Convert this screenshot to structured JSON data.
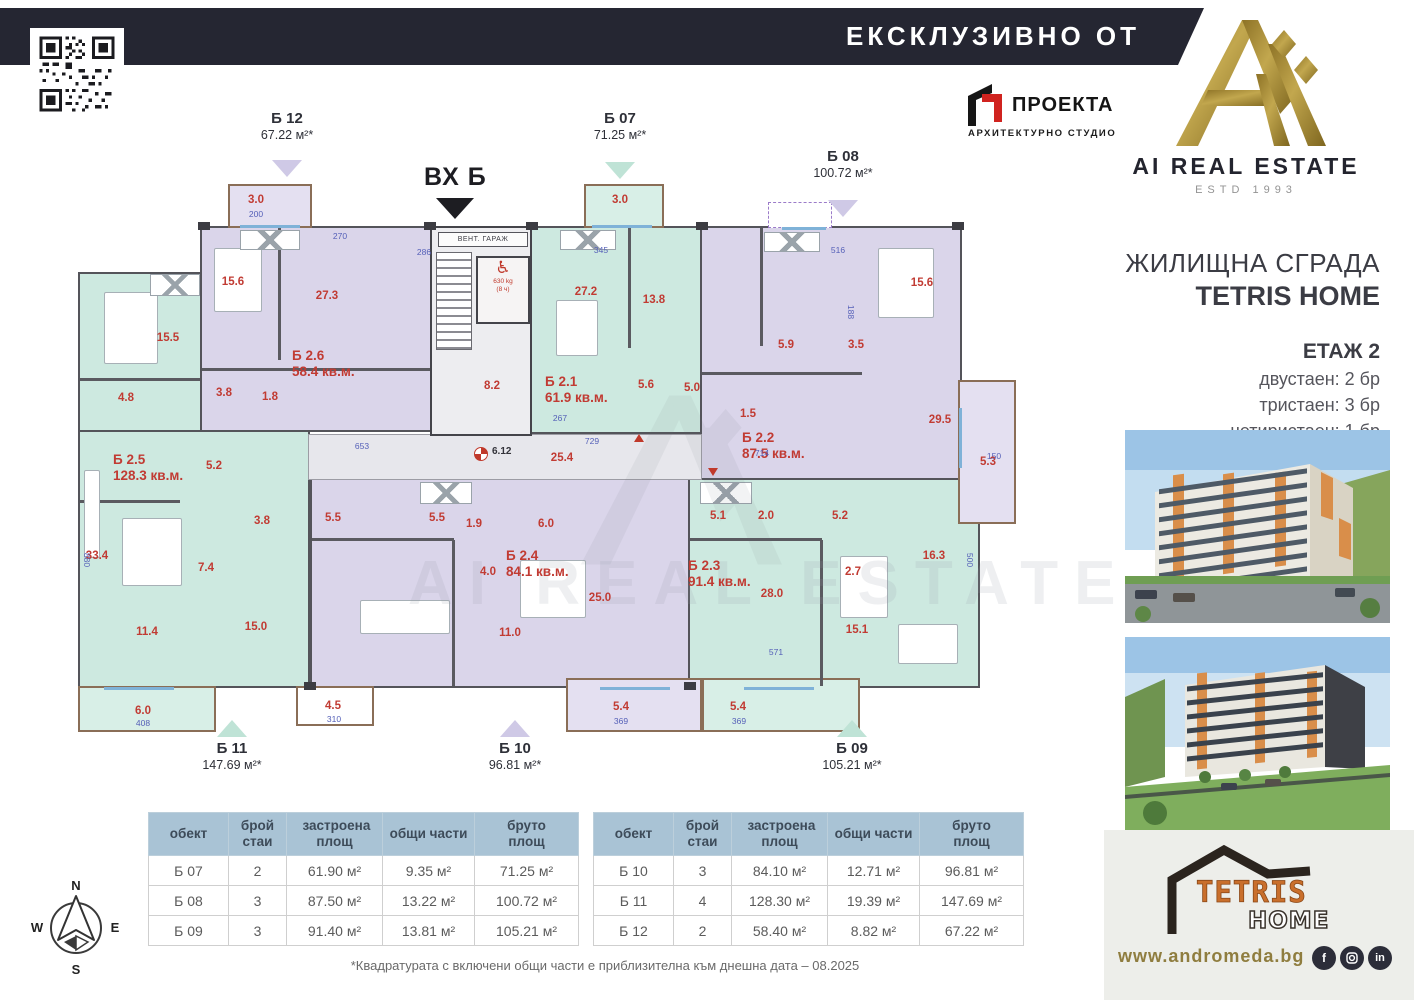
{
  "header": {
    "exclusive": "ЕКСКЛУЗИВНО ОТ"
  },
  "brand": {
    "name": "AI REAL ESTATE",
    "estd": "ESTD 1993"
  },
  "architect": {
    "name": "ПРОЕКТА",
    "subtitle": "АРХИТЕКТУРНО СТУДИО"
  },
  "project": {
    "type": "ЖИЛИЩНА СГРАДА",
    "name": "TETRIS HOME",
    "floor": "ЕТАЖ 2",
    "units": [
      "двустаен: 2 бр",
      "тристаен: 3 бр",
      "четиристаен: 1 бр"
    ]
  },
  "plan": {
    "entrance": "ВХ Б",
    "vent": "ВЕНТ. ГАРАЖ",
    "elevator_capacity": "630 kg",
    "elevator_persons": "(8 ч)",
    "survey_point": "6.12",
    "callouts": [
      {
        "id": "Б 12",
        "area": "67.22 м²*"
      },
      {
        "id": "Б 07",
        "area": "71.25 м²*"
      },
      {
        "id": "Б 08",
        "area": "100.72 м²*"
      },
      {
        "id": "Б 11",
        "area": "147.69 м²*"
      },
      {
        "id": "Б 10",
        "area": "96.81 м²*"
      },
      {
        "id": "Б 09",
        "area": "105.21 м²*"
      }
    ],
    "apartments": [
      {
        "id": "Б 2.5",
        "area": "128.3 кв.м."
      },
      {
        "id": "Б 2.6",
        "area": "58.4 кв.м."
      },
      {
        "id": "Б 2.1",
        "area": "61.9 кв.м."
      },
      {
        "id": "Б 2.2",
        "area": "87.5 кв.м."
      },
      {
        "id": "Б 2.4",
        "area": "84.1 кв.м."
      },
      {
        "id": "Б 2.3",
        "area": "91.4 кв.м."
      }
    ],
    "rooms": [
      "15.5",
      "4.8",
      "3.8",
      "1.8",
      "15.6",
      "27.3",
      "5.2",
      "5.5",
      "3.8",
      "33.4",
      "7.4",
      "11.4",
      "15.0",
      "27.2",
      "13.8",
      "5.6",
      "5.0",
      "15.6",
      "5.9",
      "3.5",
      "29.5",
      "1.5",
      "1.9",
      "6.0",
      "5.5",
      "4.0",
      "25.0",
      "11.0",
      "5.1",
      "2.0",
      "5.2",
      "28.0",
      "2.7",
      "16.3",
      "15.1",
      "3.0",
      "3.0",
      "5.3",
      "6.0",
      "4.5",
      "5.4",
      "5.4",
      "8.2",
      "25.4"
    ],
    "dims": [
      "200",
      "270",
      "286",
      "345",
      "516",
      "188",
      "653",
      "729",
      "714",
      "150",
      "408",
      "310",
      "369",
      "369",
      "571",
      "880",
      "500",
      "267"
    ]
  },
  "tables": {
    "headers": [
      "обект",
      "брой стаи",
      "застроена площ",
      "общи части",
      "бруто площ"
    ],
    "left": {
      "rows": [
        [
          "Б 07",
          "2",
          "61.90 м²",
          "9.35 м²",
          "71.25 м²"
        ],
        [
          "Б 08",
          "3",
          "87.50 м²",
          "13.22 м²",
          "100.72 м²"
        ],
        [
          "Б 09",
          "3",
          "91.40 м²",
          "13.81 м²",
          "105.21 м²"
        ]
      ]
    },
    "right": {
      "rows": [
        [
          "Б 10",
          "3",
          "84.10 м²",
          "12.71 м²",
          "96.81 м²"
        ],
        [
          "Б 11",
          "4",
          "128.30 м²",
          "19.39 м²",
          "147.69 м²"
        ],
        [
          "Б 12",
          "2",
          "58.40 м²",
          "8.82 м²",
          "67.22 м²"
        ]
      ]
    }
  },
  "compass": {
    "n": "N",
    "e": "E",
    "s": "S",
    "w": "W"
  },
  "tetris_logo": {
    "line1": "TETRIS",
    "line2": "HOME"
  },
  "footer": {
    "disclaimer": "*Квадратурата с включени общи части е приблизителна към днешна дата – 08.2025",
    "website": "www.andromeda.bg"
  },
  "colors": {
    "bar": "#252632",
    "gold": "#a3883c",
    "teal": "#cde9e0",
    "lavender": "#dad5ea",
    "table_header": "#a9c3d5",
    "label_red": "#c13b33"
  }
}
